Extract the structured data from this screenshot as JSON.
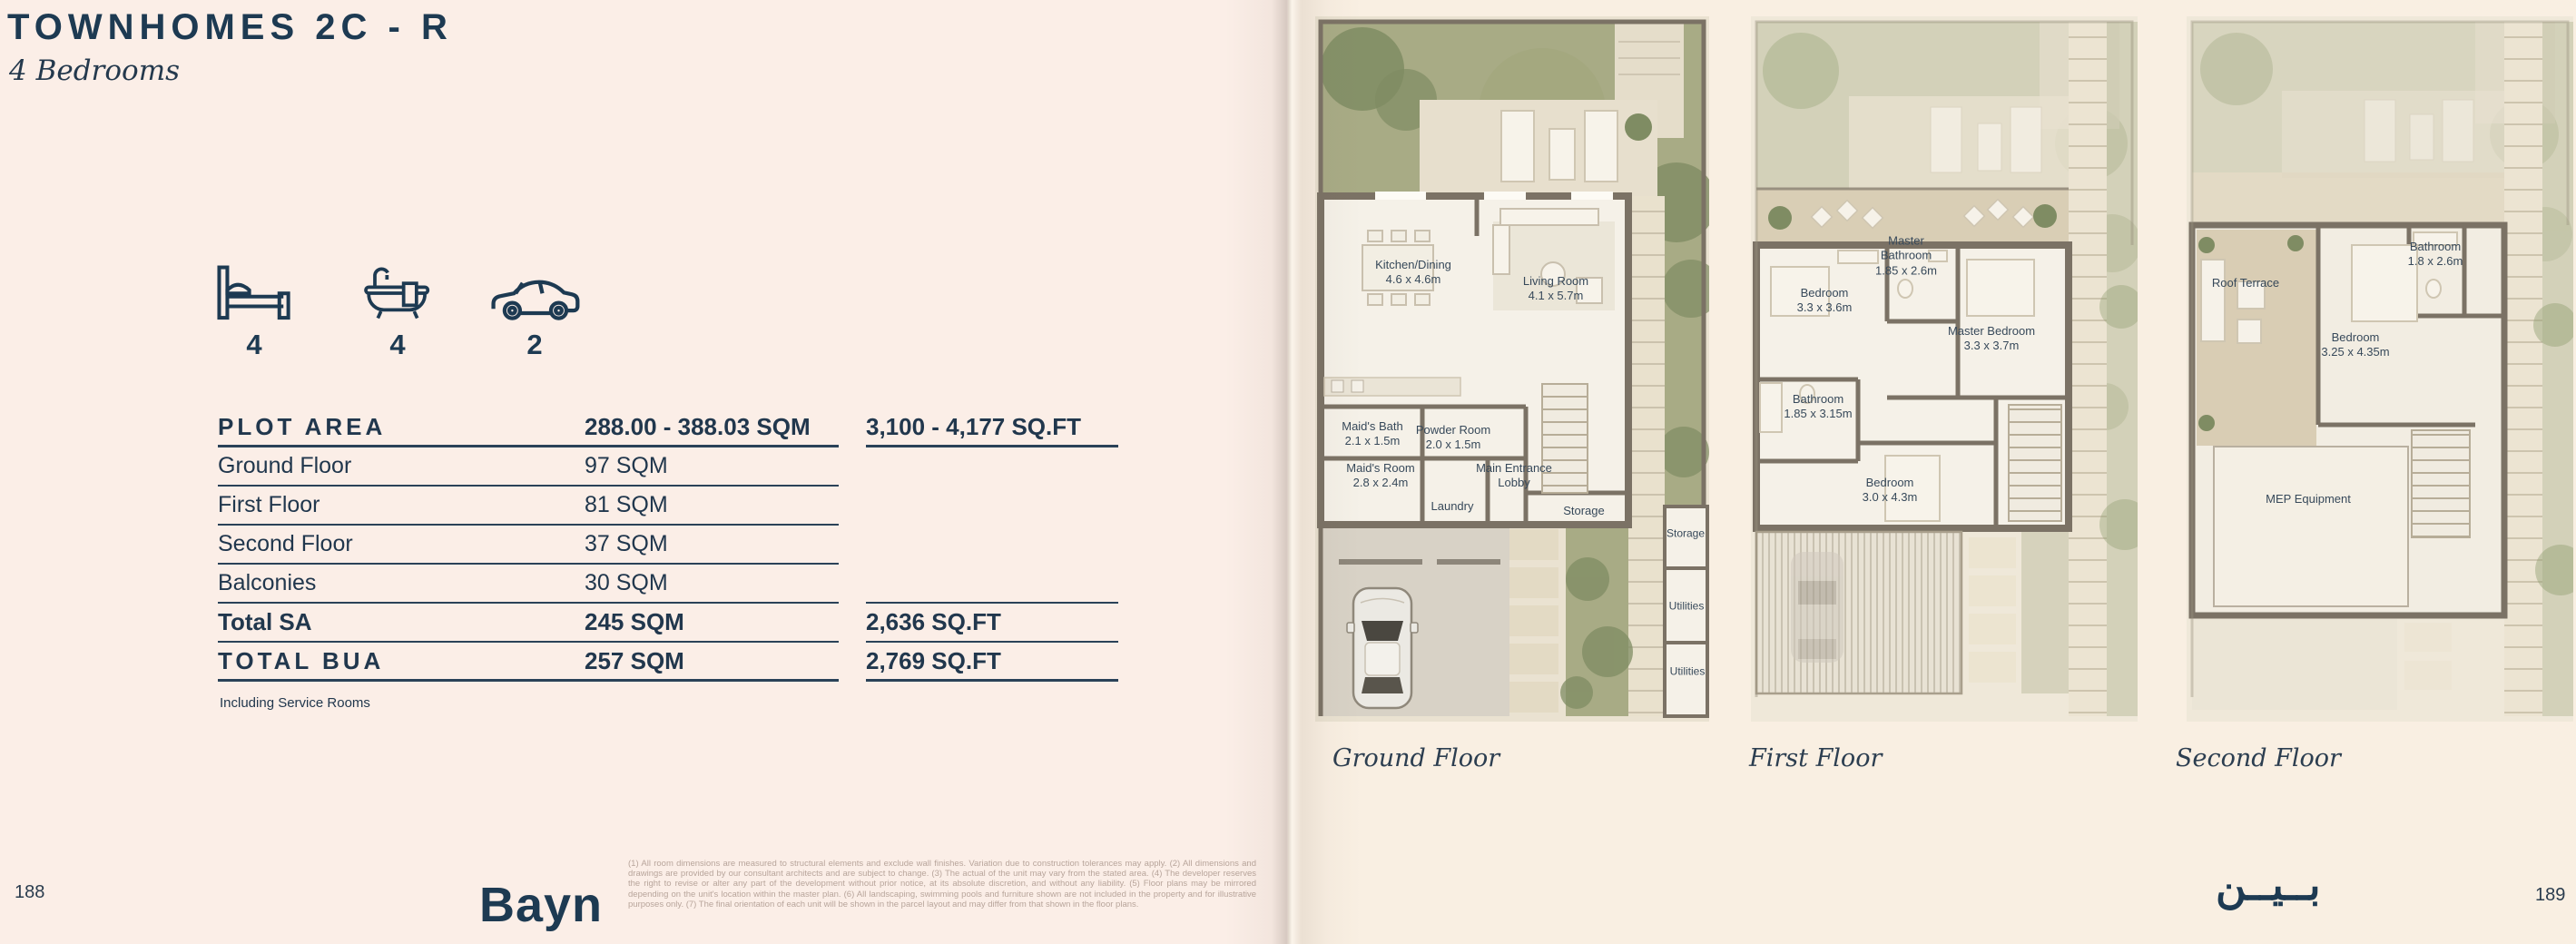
{
  "colors": {
    "brand_navy": "#1d3a52"
  },
  "header": {
    "title": "TOWNHOMES 2C - R",
    "subtitle": "4 Bedrooms"
  },
  "stats": {
    "bedrooms": "4",
    "bathrooms": "4",
    "parking": "2"
  },
  "area_table": {
    "rows": [
      {
        "label": "PLOT AREA",
        "sqm": "288.00 - 388.03 SQM",
        "sqft": "3,100 - 4,177 SQ.FT"
      },
      {
        "label": "Ground Floor",
        "sqm": "97 SQM",
        "sqft": ""
      },
      {
        "label": "First Floor",
        "sqm": "81 SQM",
        "sqft": ""
      },
      {
        "label": "Second Floor",
        "sqm": "37 SQM",
        "sqft": ""
      },
      {
        "label": "Balconies",
        "sqm": "30 SQM",
        "sqft": ""
      },
      {
        "label": "Total  SA",
        "sqm": "245 SQM",
        "sqft": "2,636 SQ.FT"
      },
      {
        "label": "TOTAL BUA",
        "sqm": "257 SQM",
        "sqft": "2,769 SQ.FT"
      }
    ],
    "note": "Including Service Rooms"
  },
  "footer": {
    "left_page_number": "188",
    "right_page_number": "189",
    "brand_wordmark": "Bayn",
    "brand_wordmark_arabic": "بــيــن",
    "disclaimer": "(1) All room dimensions are measured to structural elements and exclude wall finishes. Variation due to construction tolerances may apply. (2) All dimensions and drawings are provided by our consultant architects and are subject to change. (3) The actual of the unit may vary from the stated area. (4) The developer reserves the right to revise or alter any part of the development without prior notice, at its absolute discretion, and without any liability. (5) Floor plans may be mirrored depending on the unit's location within the master plan. (6) All landscaping, swimming pools and furniture shown are not included in the property and for illustrative purposes only. (7) The final orientation of each unit will be shown in the parcel layout and may differ from that shown in the floor plans."
  },
  "plans": [
    {
      "caption": "Ground Floor",
      "rooms": [
        {
          "name": "Kitchen/Dining",
          "dims": "4.6 x 4.6m"
        },
        {
          "name": "Living Room",
          "dims": "4.1 x 5.7m"
        },
        {
          "name": "Maid's Bath",
          "dims": "2.1 x 1.5m"
        },
        {
          "name": "Powder Room",
          "dims": "2.0 x 1.5m"
        },
        {
          "name": "Maid's Room",
          "dims": "2.8 x 2.4m"
        },
        {
          "name": "Main Entrance Lobby",
          "dims": ""
        },
        {
          "name": "Laundry",
          "dims": ""
        },
        {
          "name": "Storage",
          "dims": ""
        },
        {
          "name": "Storage",
          "dims": ""
        },
        {
          "name": "Utilities",
          "dims": ""
        },
        {
          "name": "Utilities",
          "dims": ""
        }
      ]
    },
    {
      "caption": "First Floor",
      "rooms": [
        {
          "name": "Master Bathroom",
          "dims": "1.85 x 2.6m"
        },
        {
          "name": "Bedroom",
          "dims": "3.3 x 3.6m"
        },
        {
          "name": "Master Bedroom",
          "dims": "3.3 x 3.7m"
        },
        {
          "name": "Bathroom",
          "dims": "1.85 x 3.15m"
        },
        {
          "name": "Bedroom",
          "dims": "3.0 x 4.3m"
        }
      ]
    },
    {
      "caption": "Second Floor",
      "rooms": [
        {
          "name": "Roof Terrace",
          "dims": ""
        },
        {
          "name": "Bathroom",
          "dims": "1.8 x 2.6m"
        },
        {
          "name": "Bedroom",
          "dims": "3.25 x 4.35m"
        },
        {
          "name": "MEP Equipment",
          "dims": ""
        }
      ]
    }
  ]
}
